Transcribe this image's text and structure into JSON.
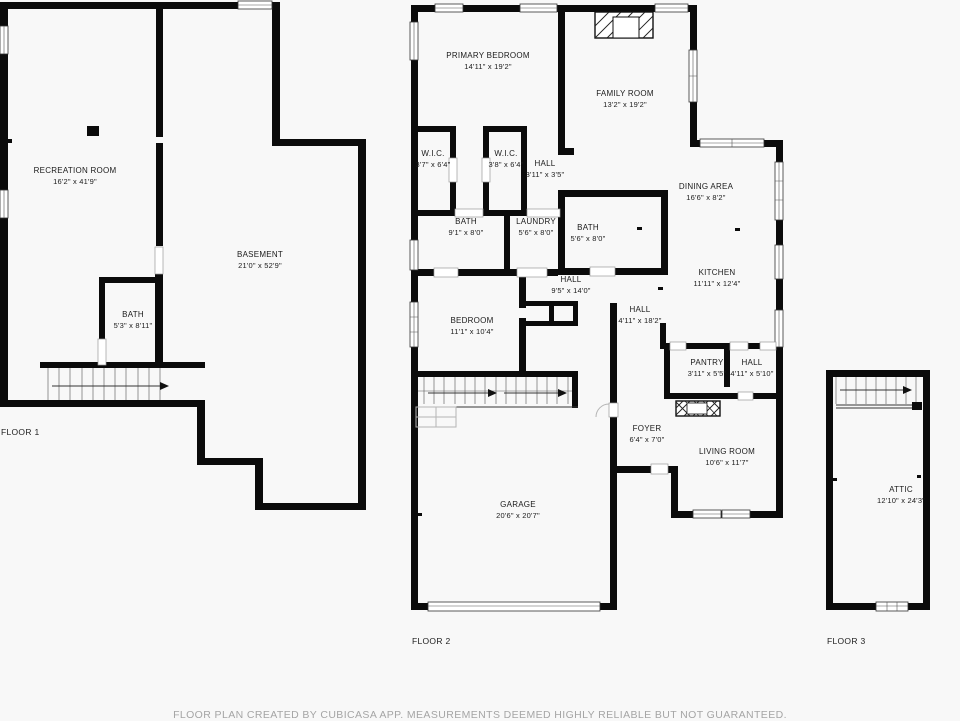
{
  "title": "Residential floor plan",
  "colors": {
    "background": "#f8f8f8",
    "wall": "#0b0b0b",
    "room_text": "#1b1b1b",
    "disclaimer_text": "#a5a5a5"
  },
  "floors": [
    {
      "label": "FLOOR 1",
      "rooms": [
        {
          "name": "RECREATION ROOM",
          "dims": "16'2\" x 41'9\"",
          "cx": 75,
          "cy": 171
        },
        {
          "name": "BASEMENT",
          "dims": "21'0\" x 52'9\"",
          "cx": 260,
          "cy": 255
        },
        {
          "name": "BATH",
          "dims": "5'3\" x 8'11\"",
          "cx": 133,
          "cy": 315
        }
      ]
    },
    {
      "label": "FLOOR 2",
      "rooms": [
        {
          "name": "PRIMARY BEDROOM",
          "dims": "14'11\" x 19'2\"",
          "cx": 488,
          "cy": 56
        },
        {
          "name": "FAMILY ROOM",
          "dims": "13'2\" x 19'2\"",
          "cx": 625,
          "cy": 94
        },
        {
          "name": "W.I.C.",
          "dims": "3'7\" x 6'4\"",
          "cx": 433,
          "cy": 154
        },
        {
          "name": "W.I.C.",
          "dims": "3'8\" x 6'4\"",
          "cx": 506,
          "cy": 154
        },
        {
          "name": "HALL",
          "dims": "3'11\" x 3'5\"",
          "cx": 545,
          "cy": 164
        },
        {
          "name": "BATH",
          "dims": "9'1\" x 8'0\"",
          "cx": 466,
          "cy": 222
        },
        {
          "name": "LAUNDRY",
          "dims": "5'6\" x 8'0\"",
          "cx": 536,
          "cy": 222
        },
        {
          "name": "BATH",
          "dims": "5'6\" x 8'0\"",
          "cx": 588,
          "cy": 228
        },
        {
          "name": "HALL",
          "dims": "9'5\" x 14'0\"",
          "cx": 571,
          "cy": 280
        },
        {
          "name": "BEDROOM",
          "dims": "11'1\" x 10'4\"",
          "cx": 472,
          "cy": 321
        },
        {
          "name": "DINING AREA",
          "dims": "16'6\" x 8'2\"",
          "cx": 706,
          "cy": 187
        },
        {
          "name": "KITCHEN",
          "dims": "11'11\" x 12'4\"",
          "cx": 717,
          "cy": 273
        },
        {
          "name": "HALL",
          "dims": "4'11\" x 18'2\"",
          "cx": 640,
          "cy": 310
        },
        {
          "name": "PANTRY",
          "dims": "3'11\" x 5'5\"",
          "cx": 707,
          "cy": 363
        },
        {
          "name": "HALL",
          "dims": "4'11\" x 5'10\"",
          "cx": 752,
          "cy": 363
        },
        {
          "name": "FOYER",
          "dims": "6'4\" x 7'0\"",
          "cx": 647,
          "cy": 429
        },
        {
          "name": "LIVING ROOM",
          "dims": "10'6\" x 11'7\"",
          "cx": 727,
          "cy": 452
        },
        {
          "name": "GARAGE",
          "dims": "20'6\" x 20'7\"",
          "cx": 518,
          "cy": 505
        }
      ]
    },
    {
      "label": "FLOOR 3",
      "rooms": [
        {
          "name": "ATTIC",
          "dims": "12'10\" x 24'3\"",
          "cx": 901,
          "cy": 490
        }
      ]
    }
  ],
  "features": [
    "staircase-with-direction-arrow",
    "fireplace",
    "windows",
    "door-openings"
  ],
  "disclaimer": "FLOOR PLAN CREATED BY CUBICASA APP. MEASUREMENTS DEEMED HIGHLY RELIABLE BUT NOT GUARANTEED."
}
